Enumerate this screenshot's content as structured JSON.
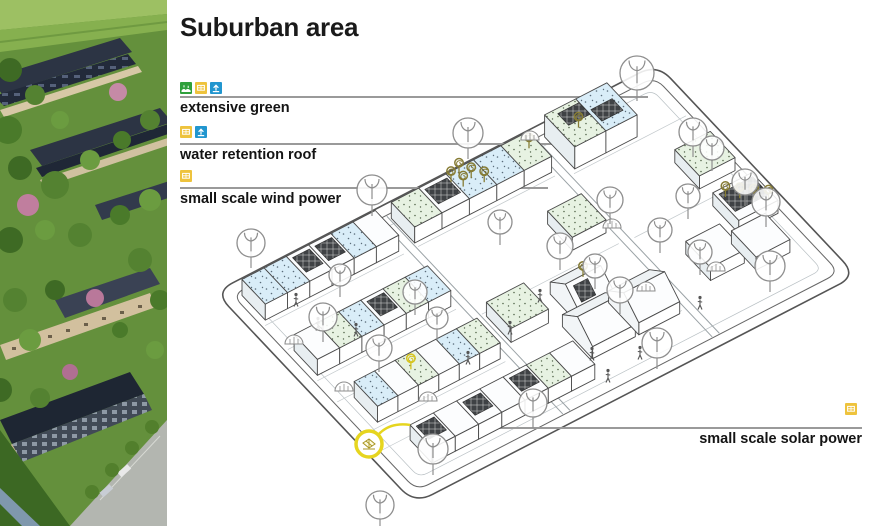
{
  "title": "Suburban area",
  "colors": {
    "legend_line": "#9a9a9a",
    "icon_green": "#2fa03c",
    "icon_yellow": "#eec33d",
    "icon_blue": "#2196cf",
    "roof_water": "#d9edf8",
    "roof_green": "#e7f2e2",
    "solar_dark": "#3f4245",
    "turbine_olive": "#867c35",
    "turbine_yellow": "#d6c41e",
    "callout_yellow": "#e6d51f"
  },
  "legend": {
    "items": [
      {
        "label": "extensive green",
        "icons": [
          "green-roof",
          "energy",
          "water"
        ],
        "icons_pos": [
          180,
          82
        ],
        "line": [
          180,
          97,
          648,
          97
        ],
        "label_pos": [
          180,
          100
        ],
        "align": "left"
      },
      {
        "label": "water retention roof",
        "icons": [
          "energy",
          "water"
        ],
        "icons_pos": [
          180,
          126
        ],
        "line": [
          180,
          144,
          563,
          144
        ],
        "label_pos": [
          180,
          147
        ],
        "align": "left"
      },
      {
        "label": "small scale wind power",
        "icons": [
          "energy"
        ],
        "icons_pos": [
          180,
          170
        ],
        "line": [
          180,
          188,
          548,
          188
        ],
        "label_pos": [
          180,
          191
        ],
        "align": "left"
      },
      {
        "label": "small scale solar power",
        "icons": [
          "energy"
        ],
        "icons_pos": [
          845,
          403
        ],
        "line": [
          470,
          428,
          862,
          428
        ],
        "label_pos": [
          862,
          431
        ],
        "align": "right"
      }
    ]
  },
  "diagram": {
    "origin": [
      215,
      292
    ],
    "u": [
      0.889,
      -0.459
    ],
    "v": [
      0.686,
      0.727
    ],
    "size": [
      497,
      291
    ],
    "border": [
      {
        "inset": 0,
        "r": 20,
        "stroke": "#555555",
        "w": 1.6
      },
      {
        "inset": 11,
        "r": 13,
        "stroke": "#666666",
        "w": 1.0
      },
      {
        "inset": 22,
        "r": 9,
        "stroke": "#b9c0c4",
        "w": 0.7
      }
    ],
    "streets": [
      [
        176,
        12,
        176,
        279
      ],
      [
        184,
        12,
        184,
        279
      ],
      [
        344,
        12,
        344,
        279
      ],
      [
        352,
        12,
        352,
        279
      ]
    ],
    "lanes": [
      [
        14,
        55,
        170,
        55
      ],
      [
        14,
        88,
        170,
        88
      ],
      [
        14,
        131,
        170,
        131
      ],
      [
        14,
        160,
        170,
        160
      ],
      [
        14,
        203,
        170,
        203
      ],
      [
        14,
        226,
        170,
        226
      ],
      [
        186,
        55,
        340,
        55
      ],
      [
        186,
        148,
        340,
        148
      ],
      [
        186,
        240,
        340,
        240
      ],
      [
        356,
        62,
        482,
        62
      ],
      [
        356,
        150,
        482,
        150
      ]
    ],
    "buildings": [
      {
        "kind": "row",
        "a": [
          18,
          168
        ],
        "b": [
          16,
          50
        ],
        "h": 16,
        "segs": [
          "water",
          "water",
          "solar",
          "solar",
          "water",
          "white"
        ]
      },
      {
        "kind": "row",
        "a": [
          186,
          340
        ],
        "b": [
          16,
          50
        ],
        "h": 16,
        "segs": [
          "green",
          "solar",
          "water",
          "water",
          "green"
        ]
      },
      {
        "kind": "row",
        "a": [
          360,
          430
        ],
        "b": [
          14,
          58
        ],
        "h": 22,
        "segs": [
          "green",
          "water"
        ],
        "bigpanels": true
      },
      {
        "kind": "row",
        "a": [
          440,
          480
        ],
        "b": [
          100,
          136
        ],
        "h": 13,
        "segs": [
          "green"
        ]
      },
      {
        "kind": "row",
        "a": [
          18,
          168
        ],
        "b": [
          92,
          126
        ],
        "h": 16,
        "segs": [
          "white",
          "green",
          "water",
          "solar",
          "green",
          "water"
        ]
      },
      {
        "kind": "row",
        "a": [
          300,
          338
        ],
        "b": [
          96,
          132
        ],
        "h": 13,
        "segs": [
          "green"
        ]
      },
      {
        "kind": "row",
        "a": [
          438,
          482
        ],
        "b": [
          158,
          196
        ],
        "h": 13,
        "segs": [
          "solar"
        ]
      },
      {
        "kind": "row",
        "a": [
          383,
          421
        ],
        "b": [
          190,
          226
        ],
        "h": 13,
        "segs": [
          "white"
        ]
      },
      {
        "kind": "row",
        "a": [
          425,
          463
        ],
        "b": [
          202,
          238
        ],
        "h": 13,
        "segs": [
          "white"
        ]
      },
      {
        "kind": "row",
        "a": [
          30,
          168
        ],
        "b": [
          164,
          198
        ],
        "h": 16,
        "segs": [
          "water",
          "white",
          "green",
          "white",
          "water",
          "green"
        ]
      },
      {
        "kind": "row",
        "a": [
          188,
          230
        ],
        "b": [
          152,
          188
        ],
        "h": 14,
        "segs": [
          "green"
        ]
      },
      {
        "kind": "pitched",
        "a": [
          252,
          292
        ],
        "b": [
          162,
          206
        ],
        "h1": 12,
        "h2": 26,
        "solar": true
      },
      {
        "kind": "pitched",
        "a": [
          238,
          286
        ],
        "b": [
          198,
          242
        ],
        "h1": 12,
        "h2": 26
      },
      {
        "kind": "pitched",
        "a": [
          290,
          336
        ],
        "b": [
          198,
          242
        ],
        "h1": 12,
        "h2": 26
      },
      {
        "kind": "row",
        "a": [
          42,
          225
        ],
        "b": [
          230,
          262
        ],
        "h": 15,
        "segs": [
          "solar",
          "white",
          "solar",
          "white",
          "solar",
          "green",
          "white"
        ]
      }
    ],
    "turbines": [
      {
        "a": 247,
        "b": 24,
        "dy": -16,
        "c": "olive"
      },
      {
        "a": 259,
        "b": 20,
        "dy": -16,
        "c": "olive"
      },
      {
        "a": 253,
        "b": 34,
        "dy": -16,
        "c": "olive"
      },
      {
        "a": 265,
        "b": 30,
        "dy": -16,
        "c": "olive"
      },
      {
        "a": 272,
        "b": 40,
        "dy": -16,
        "c": "olive"
      },
      {
        "a": 330,
        "b": 30,
        "dy": -16,
        "c": "olive"
      },
      {
        "a": 446,
        "b": 166,
        "dy": -13,
        "c": "olive"
      },
      {
        "a": 456,
        "b": 174,
        "dy": -13,
        "c": "olive"
      },
      {
        "a": 466,
        "b": 182,
        "dy": -13,
        "c": "olive"
      },
      {
        "a": 476,
        "b": 190,
        "dy": -13,
        "c": "olive"
      },
      {
        "a": 83,
        "b": 178,
        "dy": -16,
        "c": "yellow"
      },
      {
        "a": 272,
        "b": 184,
        "dy": -26,
        "c": "olive"
      },
      {
        "a": 378,
        "b": 40,
        "dy": -22,
        "c": "olive"
      }
    ],
    "trees": [
      [
        637,
        73,
        17
      ],
      [
        468,
        133,
        15
      ],
      [
        372,
        190,
        15
      ],
      [
        251,
        243,
        14
      ],
      [
        323,
        317,
        14
      ],
      [
        379,
        348,
        13
      ],
      [
        415,
        292,
        12
      ],
      [
        437,
        318,
        11
      ],
      [
        433,
        449,
        15
      ],
      [
        380,
        505,
        14
      ],
      [
        533,
        403,
        14
      ],
      [
        657,
        343,
        15
      ],
      [
        610,
        200,
        13
      ],
      [
        693,
        132,
        14
      ],
      [
        712,
        148,
        12
      ],
      [
        688,
        196,
        12
      ],
      [
        660,
        230,
        12
      ],
      [
        745,
        182,
        13
      ],
      [
        766,
        202,
        14
      ],
      [
        770,
        266,
        15
      ],
      [
        700,
        252,
        12
      ],
      [
        560,
        246,
        13
      ],
      [
        595,
        266,
        12
      ],
      [
        620,
        290,
        13
      ],
      [
        500,
        222,
        12
      ],
      [
        340,
        275,
        11
      ]
    ],
    "bushes": [
      [
        530,
        140
      ],
      [
        612,
        228
      ],
      [
        646,
        291
      ],
      [
        344,
        391
      ],
      [
        428,
        401
      ],
      [
        716,
        271
      ],
      [
        294,
        344
      ]
    ],
    "people": [
      [
        296,
        302
      ],
      [
        318,
        326
      ],
      [
        356,
        332
      ],
      [
        540,
        298
      ],
      [
        592,
        356
      ],
      [
        468,
        360
      ],
      [
        608,
        378
      ],
      [
        700,
        305
      ],
      [
        510,
        330
      ],
      [
        640,
        355
      ]
    ],
    "callout": {
      "cx": 369,
      "cy": 444,
      "r": 13,
      "roof": [
        42,
        230,
        -15
      ]
    }
  }
}
